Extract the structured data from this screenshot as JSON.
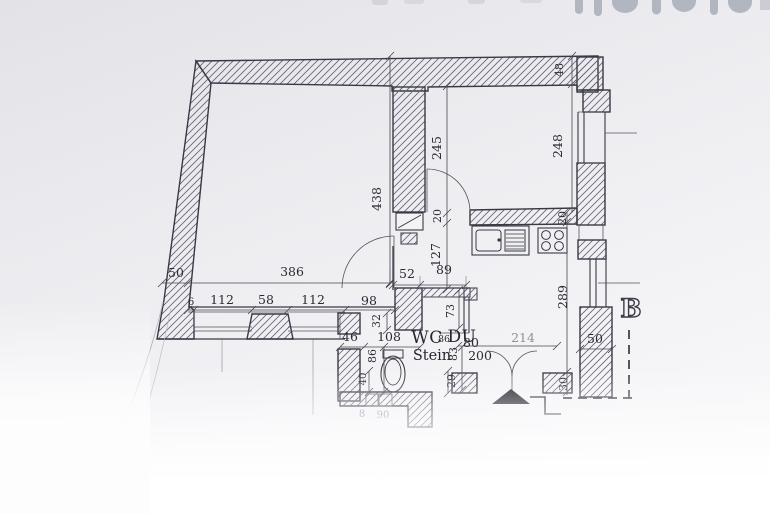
{
  "labels": {
    "wc": "WC",
    "wc_mid_dim": "86",
    "du": "DU",
    "stein": "Stein",
    "section_marker": "B"
  },
  "colors": {
    "ink": "#393945",
    "dim_text": "#2b2b36",
    "faint_text": "#8e8e99",
    "paper": "#ececef"
  },
  "dimension_labels": [
    {
      "t": "50",
      "x": 176,
      "y": 277
    },
    {
      "t": "386",
      "x": 292,
      "y": 276
    },
    {
      "t": "6",
      "x": 191,
      "y": 305,
      "s": 10.5
    },
    {
      "t": "112",
      "x": 222,
      "y": 304
    },
    {
      "t": "58",
      "x": 266,
      "y": 304
    },
    {
      "t": "112",
      "x": 313,
      "y": 304
    },
    {
      "t": "98",
      "x": 369,
      "y": 305
    },
    {
      "t": "438",
      "x": 381,
      "y": 199,
      "r": -90
    },
    {
      "t": "245",
      "x": 441,
      "y": 148,
      "r": -90
    },
    {
      "t": "20",
      "x": 441,
      "y": 216,
      "r": -90,
      "s": 11
    },
    {
      "t": "127",
      "x": 440,
      "y": 255,
      "r": -90
    },
    {
      "t": "248",
      "x": 562,
      "y": 146,
      "r": -90
    },
    {
      "t": "48",
      "x": 563,
      "y": 70,
      "r": -90,
      "s": 11
    },
    {
      "t": "20",
      "x": 566,
      "y": 218,
      "r": -90,
      "s": 11
    },
    {
      "t": "52",
      "x": 407,
      "y": 278
    },
    {
      "t": "89",
      "x": 444,
      "y": 274
    },
    {
      "t": "32",
      "x": 380,
      "y": 321,
      "r": -90,
      "s": 11
    },
    {
      "t": "46",
      "x": 350,
      "y": 341
    },
    {
      "t": "108",
      "x": 389,
      "y": 341
    },
    {
      "t": "86",
      "x": 376,
      "y": 356,
      "r": -90,
      "s": 11
    },
    {
      "t": "40",
      "x": 366,
      "y": 379,
      "r": -90,
      "s": 10
    },
    {
      "t": "73",
      "x": 454,
      "y": 311,
      "r": -90,
      "s": 11
    },
    {
      "t": "83",
      "x": 457,
      "y": 354,
      "r": -90,
      "s": 11
    },
    {
      "t": "80",
      "x": 471,
      "y": 347
    },
    {
      "t": "200",
      "x": 480,
      "y": 360
    },
    {
      "t": "29",
      "x": 455,
      "y": 381,
      "r": -90,
      "s": 11
    },
    {
      "t": "214",
      "x": 523,
      "y": 342,
      "c": "#90909b"
    },
    {
      "t": "30",
      "x": 567,
      "y": 384,
      "r": -90,
      "s": 11
    },
    {
      "t": "289",
      "x": 567,
      "y": 297,
      "r": -90
    },
    {
      "t": "50",
      "x": 595,
      "y": 343
    },
    {
      "t": "8",
      "x": 362,
      "y": 417,
      "s": 10,
      "c": "#8e8e99"
    },
    {
      "t": "90",
      "x": 383,
      "y": 418,
      "s": 10,
      "c": "#8e8e99"
    }
  ]
}
